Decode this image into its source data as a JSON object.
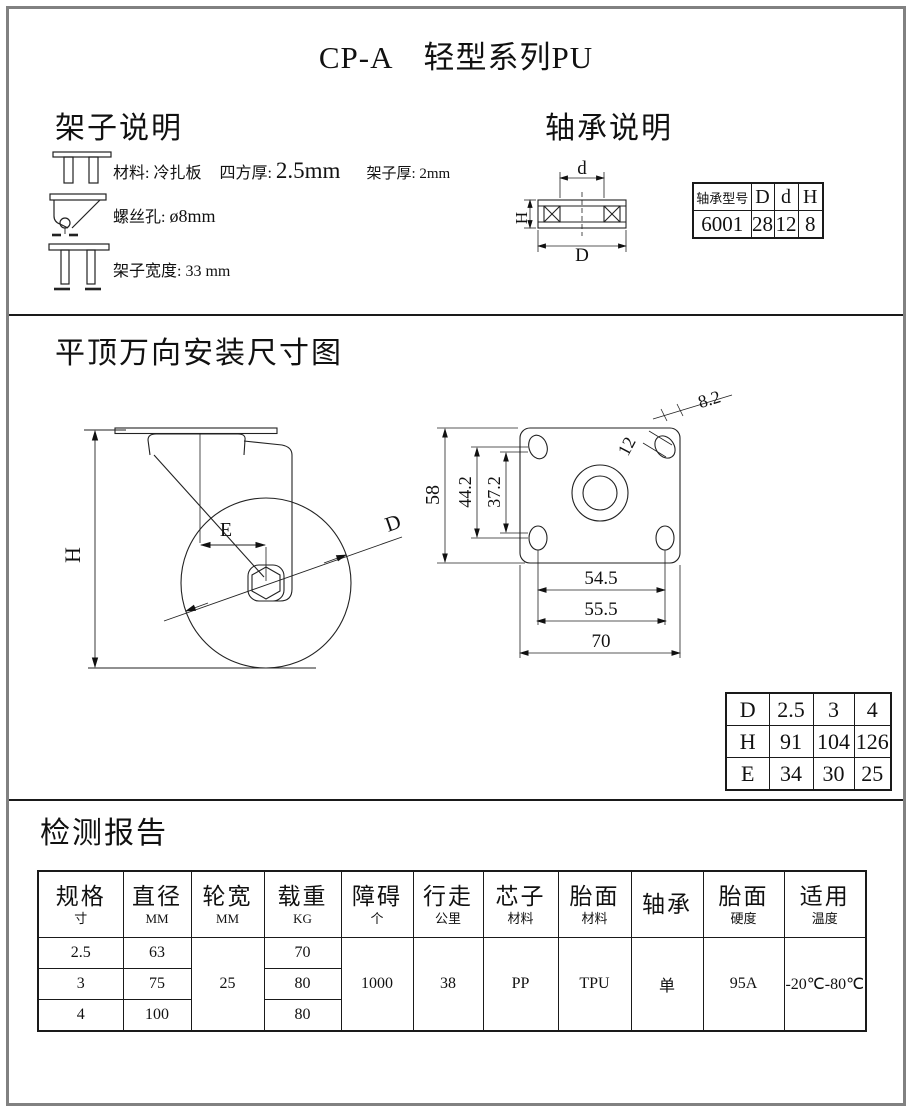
{
  "page": {
    "title_code": "CP-A",
    "title_series": "轻型系列PU"
  },
  "frame_spec": {
    "heading": "架子说明",
    "material": "材料: 冷扎板",
    "square_label": "四方厚:",
    "square_value": "2.5mm",
    "frame_thickness": "架子厚: 2mm",
    "screw_hole_label": "螺丝孔:",
    "screw_hole_value": "ø8mm",
    "width_label": "架子宽度:",
    "width_value": "33 mm"
  },
  "bearing_spec": {
    "heading": "轴承说明",
    "diagram": {
      "d": "d",
      "H": "H",
      "D": "D"
    },
    "table": {
      "headers": [
        "轴承型号",
        "D",
        "d",
        "H"
      ],
      "row": [
        "6001",
        "28",
        "12",
        "8"
      ]
    }
  },
  "mounting": {
    "heading": "平顶万向安装尺寸图",
    "side_view": {
      "height": "H",
      "offset": "E",
      "diameter": "D"
    },
    "plate_view": {
      "plate_height": "58",
      "hole_pitch_v": "44.2",
      "hole_inner_v": "37.2",
      "hole_length": "12",
      "hole_width": "8.2",
      "hole_pitch_h": "54.5",
      "hole_pitch_h2": "55.5",
      "plate_width": "70"
    },
    "dhe_table": {
      "rows": [
        [
          "D",
          "2.5",
          "3",
          "4"
        ],
        [
          "H",
          "91",
          "104",
          "126"
        ],
        [
          "E",
          "34",
          "30",
          "25"
        ]
      ]
    }
  },
  "report": {
    "heading": "检测报告",
    "table": {
      "columns": [
        {
          "title": "规格",
          "sub": "寸"
        },
        {
          "title": "直径",
          "sub": "MM"
        },
        {
          "title": "轮宽",
          "sub": "MM"
        },
        {
          "title": "载重",
          "sub": "KG"
        },
        {
          "title": "障碍",
          "sub": "个"
        },
        {
          "title": "行走",
          "sub": "公里"
        },
        {
          "title": "芯子",
          "sub": "材料"
        },
        {
          "title": "胎面",
          "sub": "材料"
        },
        {
          "title": "轴承",
          "sub": ""
        },
        {
          "title": "胎面",
          "sub": "硬度"
        },
        {
          "title": "适用",
          "sub": "温度"
        }
      ],
      "spec_rows": [
        {
          "size": "2.5",
          "diameter": "63",
          "load": "70"
        },
        {
          "size": "3",
          "diameter": "75",
          "load": "80"
        },
        {
          "size": "4",
          "diameter": "100",
          "load": "80"
        }
      ],
      "merged": {
        "wheel_width": "25",
        "obstacle": "1000",
        "distance": "38",
        "core_material": "PP",
        "tread_material": "TPU",
        "bearing": "单",
        "tread_hardness": "95A",
        "temperature": "-20℃-80℃"
      }
    }
  }
}
